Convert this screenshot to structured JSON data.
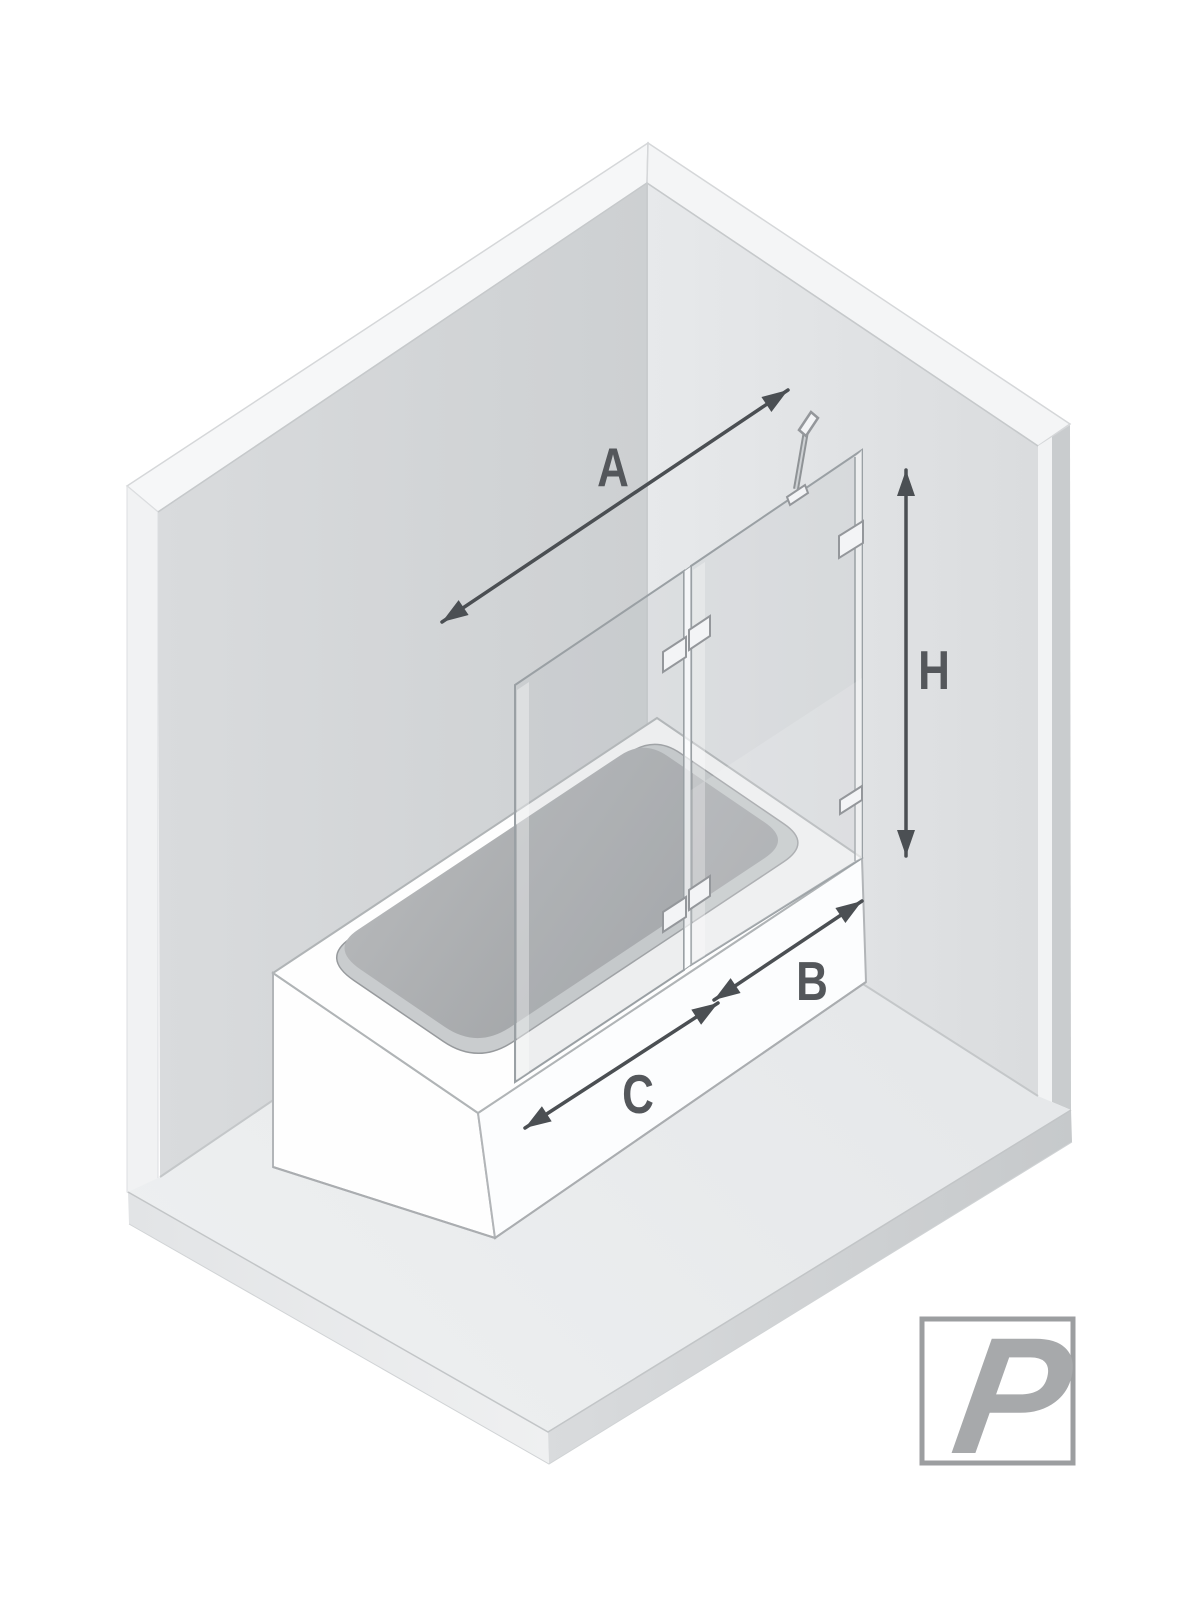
{
  "diagram": {
    "dimension_labels": {
      "total_width": "A",
      "height": "H",
      "door_panel_width": "B",
      "fixed_panel_width": "C"
    },
    "logo_letter": "P"
  },
  "colors": {
    "dimension_label": "#54575b",
    "dimension_arrow": "#4b4f53",
    "logo_gray": "#a7a9ab",
    "logo_border": "#9c9ea0",
    "wall_left": "#d4d6d8",
    "wall_right": "#e0e2e4",
    "floor": "#e9ebed",
    "bathtub_white": "#fdfdfd",
    "basin_gray": "#a3a6a9",
    "glass_stroke": "#9aa0a4"
  }
}
